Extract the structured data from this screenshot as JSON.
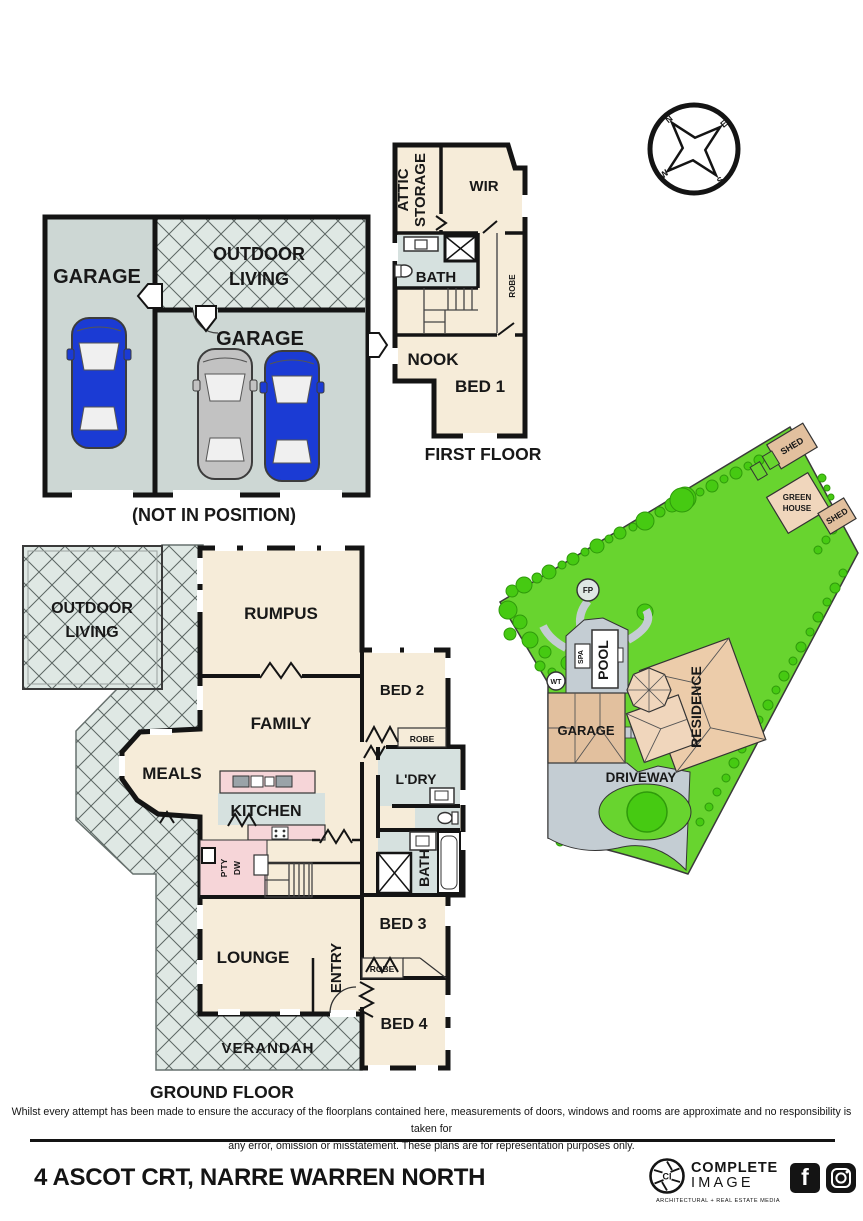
{
  "garage_plan": {
    "garage_left_label": "GARAGE",
    "outdoor_living_line1": "OUTDOOR",
    "outdoor_living_line2": "LIVING",
    "garage_main_label": "GARAGE",
    "caption": "(NOT IN POSITION)"
  },
  "first_floor": {
    "title": "FIRST FLOOR",
    "attic_line1": "ATTIC",
    "attic_line2": "STORAGE",
    "wir": "WIR",
    "bath": "BATH",
    "robe": "ROBE",
    "nook": "NOOK",
    "bed1": "BED 1"
  },
  "ground_floor": {
    "title": "GROUND FLOOR",
    "outdoor_living_line1": "OUTDOOR",
    "outdoor_living_line2": "LIVING",
    "rumpus": "RUMPUS",
    "family": "FAMILY",
    "meals": "MEALS",
    "kitchen": "KITCHEN",
    "pantry_line1": "P'TY",
    "pantry_line2": "DW",
    "lounge": "LOUNGE",
    "entry": "ENTRY",
    "verandah": "VERANDAH",
    "bed2": "BED 2",
    "robe_bed2": "ROBE",
    "ldry": "L'DRY",
    "bath": "BATH",
    "bed3": "BED 3",
    "robe_bed3": "ROBE",
    "bed4": "BED 4"
  },
  "site_plan": {
    "shed_top": "SHED",
    "greenhouse_line1": "GREEN",
    "greenhouse_line2": "HOUSE",
    "shed_right": "SHED",
    "fp": "FP",
    "wt": "WT",
    "spa": "SPA",
    "pool": "POOL",
    "garage": "GARAGE",
    "residence": "RESIDENCE",
    "driveway": "DRIVEWAY"
  },
  "compass": {
    "n": "N",
    "e": "E",
    "s": "S",
    "w": "W"
  },
  "footer": {
    "disclaimer_line1": "Whilst every attempt has been made to ensure the accuracy of the floorplans contained here, measurements of doors, windows and rooms are approximate and no responsibility is taken for",
    "disclaimer_line2": "any error, omission or misstatement. These plans are for representation purposes only.",
    "address": "4 ASCOT CRT, NARRE WARREN NORTH",
    "logo": {
      "monogram": "CI",
      "line1": "COMPLETE",
      "line2": "IMAGE",
      "tagline": "ARCHITECTURAL + REAL ESTATE MEDIA"
    },
    "social": {
      "facebook": "f"
    }
  },
  "colors": {
    "wall": "#141414",
    "floor_cream": "#f6ecd9",
    "hatch_fill": "#dfe8e4",
    "garage_fill": "#cdd7d4",
    "wet_area": "#d6e1df",
    "kitchen_pink": "#f6d5d8",
    "lawn_green": "#68d42f",
    "tree_green": "#46ca12",
    "paving_gray": "#c4cdd3",
    "building_tan": "#e2c09e",
    "building_light": "#f0d6bc",
    "car_blue": "#1b3bd4",
    "car_silver": "#c2c2c2"
  }
}
